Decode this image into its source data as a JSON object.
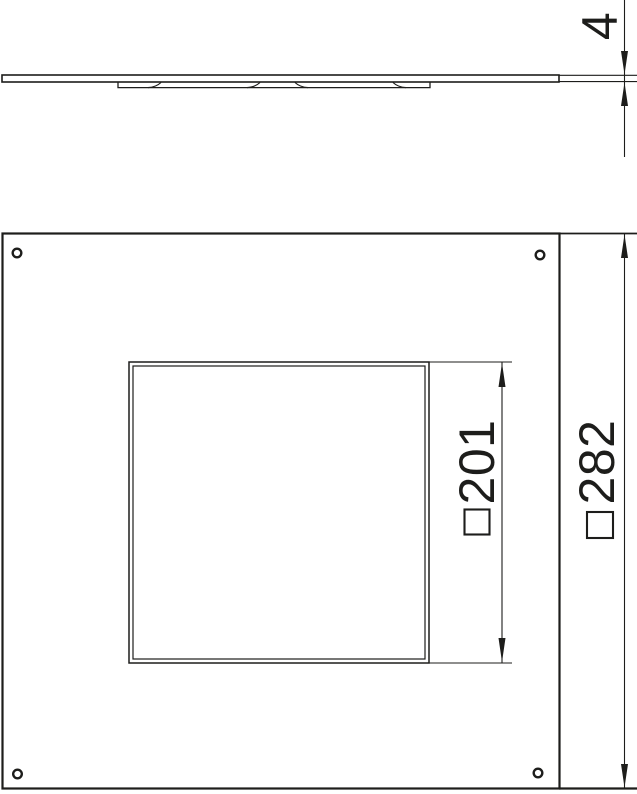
{
  "page": {
    "background_color": "#ffffff",
    "line_color": "#1d1d1b"
  },
  "side_view": {
    "thickness_dimension": {
      "value": "4"
    }
  },
  "plan_view": {
    "cutout_dimension": {
      "symbol": "□",
      "value": "201"
    },
    "overall_dimension": {
      "symbol": "□",
      "value": "282"
    }
  }
}
